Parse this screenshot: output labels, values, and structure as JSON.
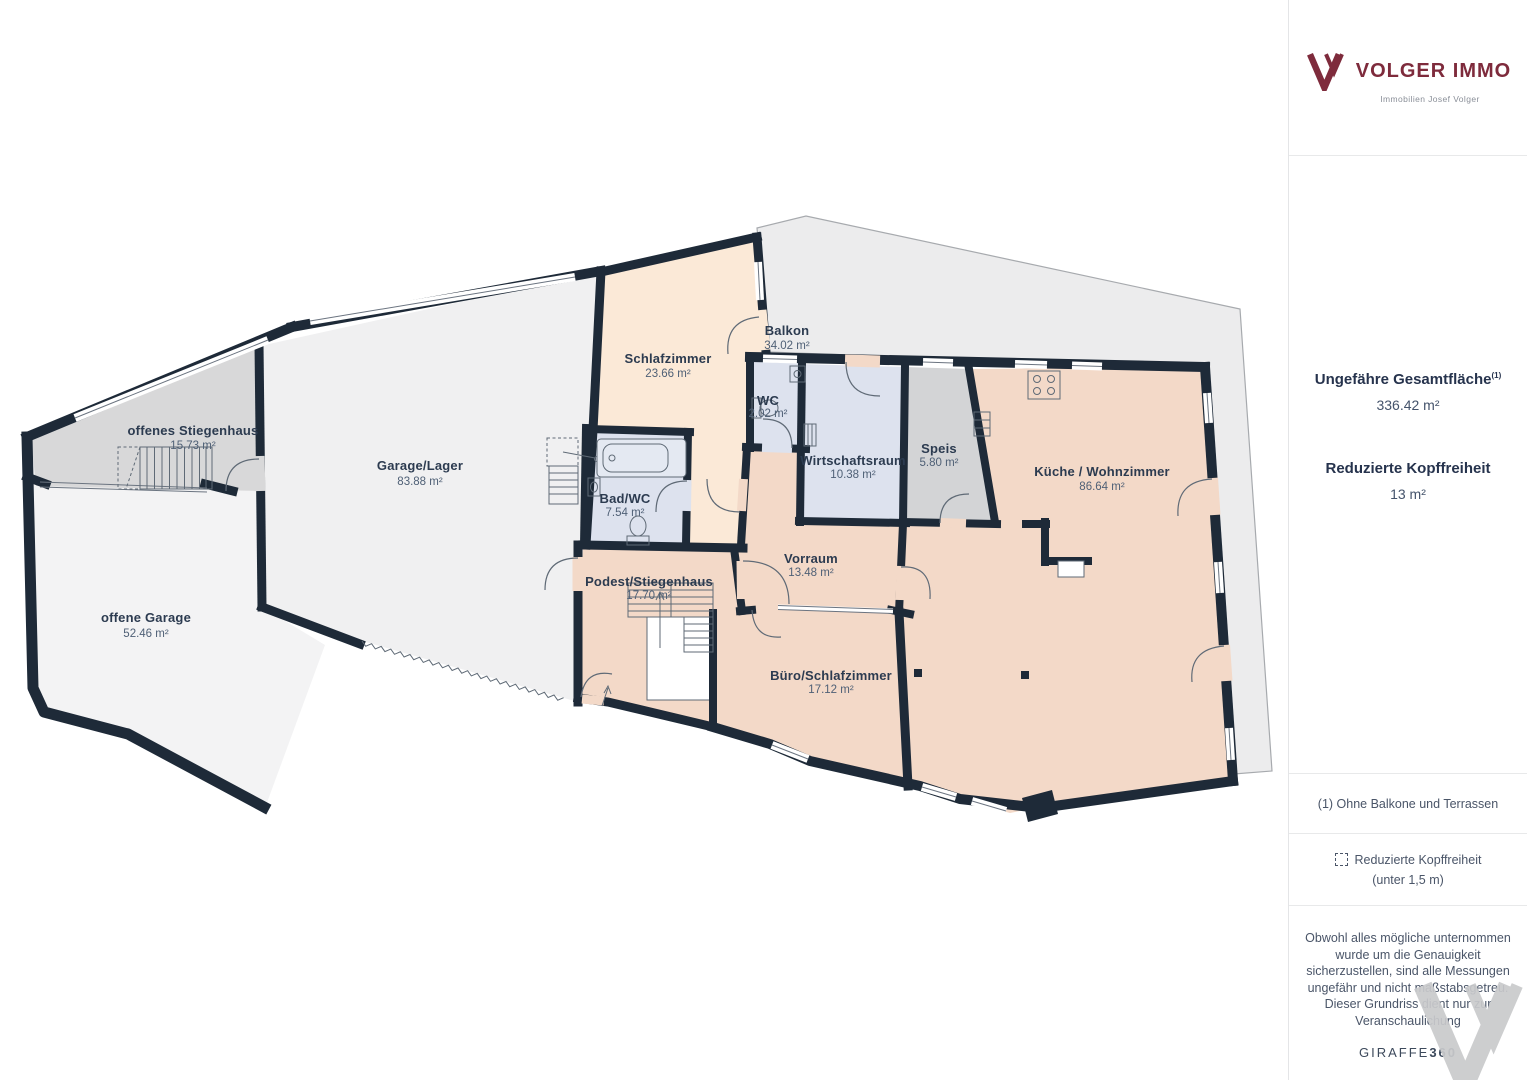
{
  "brand": {
    "name": "VOLGER IMMO",
    "tagline": "Immobilien Josef Volger",
    "logo_color": "#7e2b3c"
  },
  "sidebar": {
    "total_area_label": "Ungefähre Gesamtfläche",
    "total_area_footnote_marker": "(1)",
    "total_area_value": "336.42 m²",
    "reduced_headroom_label": "Reduzierte Kopffreiheit",
    "reduced_headroom_value": "13 m²",
    "footnote_1": "(1) Ohne Balkone und Terrassen",
    "legend_reduced_headroom_line1": "Reduzierte Kopffreiheit",
    "legend_reduced_headroom_line2": "(unter 1,5 m)",
    "disclaimer": "Obwohl alles mögliche unternommen wurde um die Genauigkeit sicherzustellen, sind alle Messungen ungefähr und nicht maßstabsgetreu. Dieser Grundriss dient nur zur Veranschaulichung",
    "giraffe_normal": "GIRAFFE",
    "giraffe_bold": "360"
  },
  "floorplan": {
    "rooms": [
      {
        "name": "offenes Stiegenhaus",
        "area": "15.73 m²"
      },
      {
        "name": "Garage/Lager",
        "area": "83.88 m²"
      },
      {
        "name": "offene Garage",
        "area": "52.46 m²"
      },
      {
        "name": "Schlafzimmer",
        "area": "23.66 m²"
      },
      {
        "name": "Balkon",
        "area": "34.02 m²"
      },
      {
        "name": "WC",
        "area": "2.02 m²"
      },
      {
        "name": "Bad/WC",
        "area": "7.54 m²"
      },
      {
        "name": "Wirtschaftsraum",
        "area": "10.38 m²"
      },
      {
        "name": "Speis",
        "area": "5.80 m²"
      },
      {
        "name": "Küche / Wohnzimmer",
        "area": "86.64 m²"
      },
      {
        "name": "Vorraum",
        "area": "13.48 m²"
      },
      {
        "name": "Podest/Stiegenhaus",
        "area": "17.70 m²"
      },
      {
        "name": "Büro/Schlafzimmer",
        "area": "17.12 m²"
      }
    ],
    "colors": {
      "wall": "#1e2a38",
      "bedroom_peach": "#fbe9d7",
      "living_pink": "#f3d9c8",
      "wet_room_blue": "#dde2ee",
      "pantry_gray": "#d3d4d6",
      "stairwell_gray": "#d8d8d9",
      "garage_gray": "#f0f0f1",
      "open_garage_gray": "#f3f3f4",
      "balcony_gray": "#ececed"
    }
  }
}
